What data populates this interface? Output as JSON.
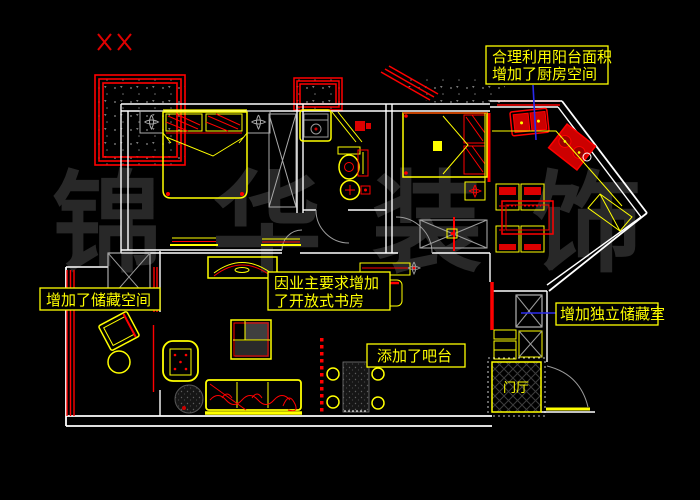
{
  "app": {
    "type": "cad-floor-plan-drawing",
    "background": "#000000"
  },
  "watermark": {
    "text": "锦华装饰",
    "color": "#282828"
  },
  "annotations": {
    "kitchen_note": {
      "line1": "合理利用阳台面积",
      "line2": "增加了厨房空间"
    },
    "storage_left_note": {
      "text": "增加了储藏空间"
    },
    "study_note": {
      "line1": "因业主要求增加",
      "line2": "了开放式书房"
    },
    "bar_note": {
      "text": "添加了吧台"
    },
    "storage_right_note": {
      "text": "增加独立储藏室"
    },
    "entry_label": {
      "text": "门厅"
    }
  },
  "colors": {
    "wall_line": "#ffffff",
    "furniture_line": "#ffff00",
    "structure_accent": "#ff0000",
    "annotation_text": "#ffff00",
    "annotation_border": "#ffff00",
    "leader_line": "#2a2aee",
    "detail_gray": "#9b9b9b",
    "watermark": "#282828"
  }
}
